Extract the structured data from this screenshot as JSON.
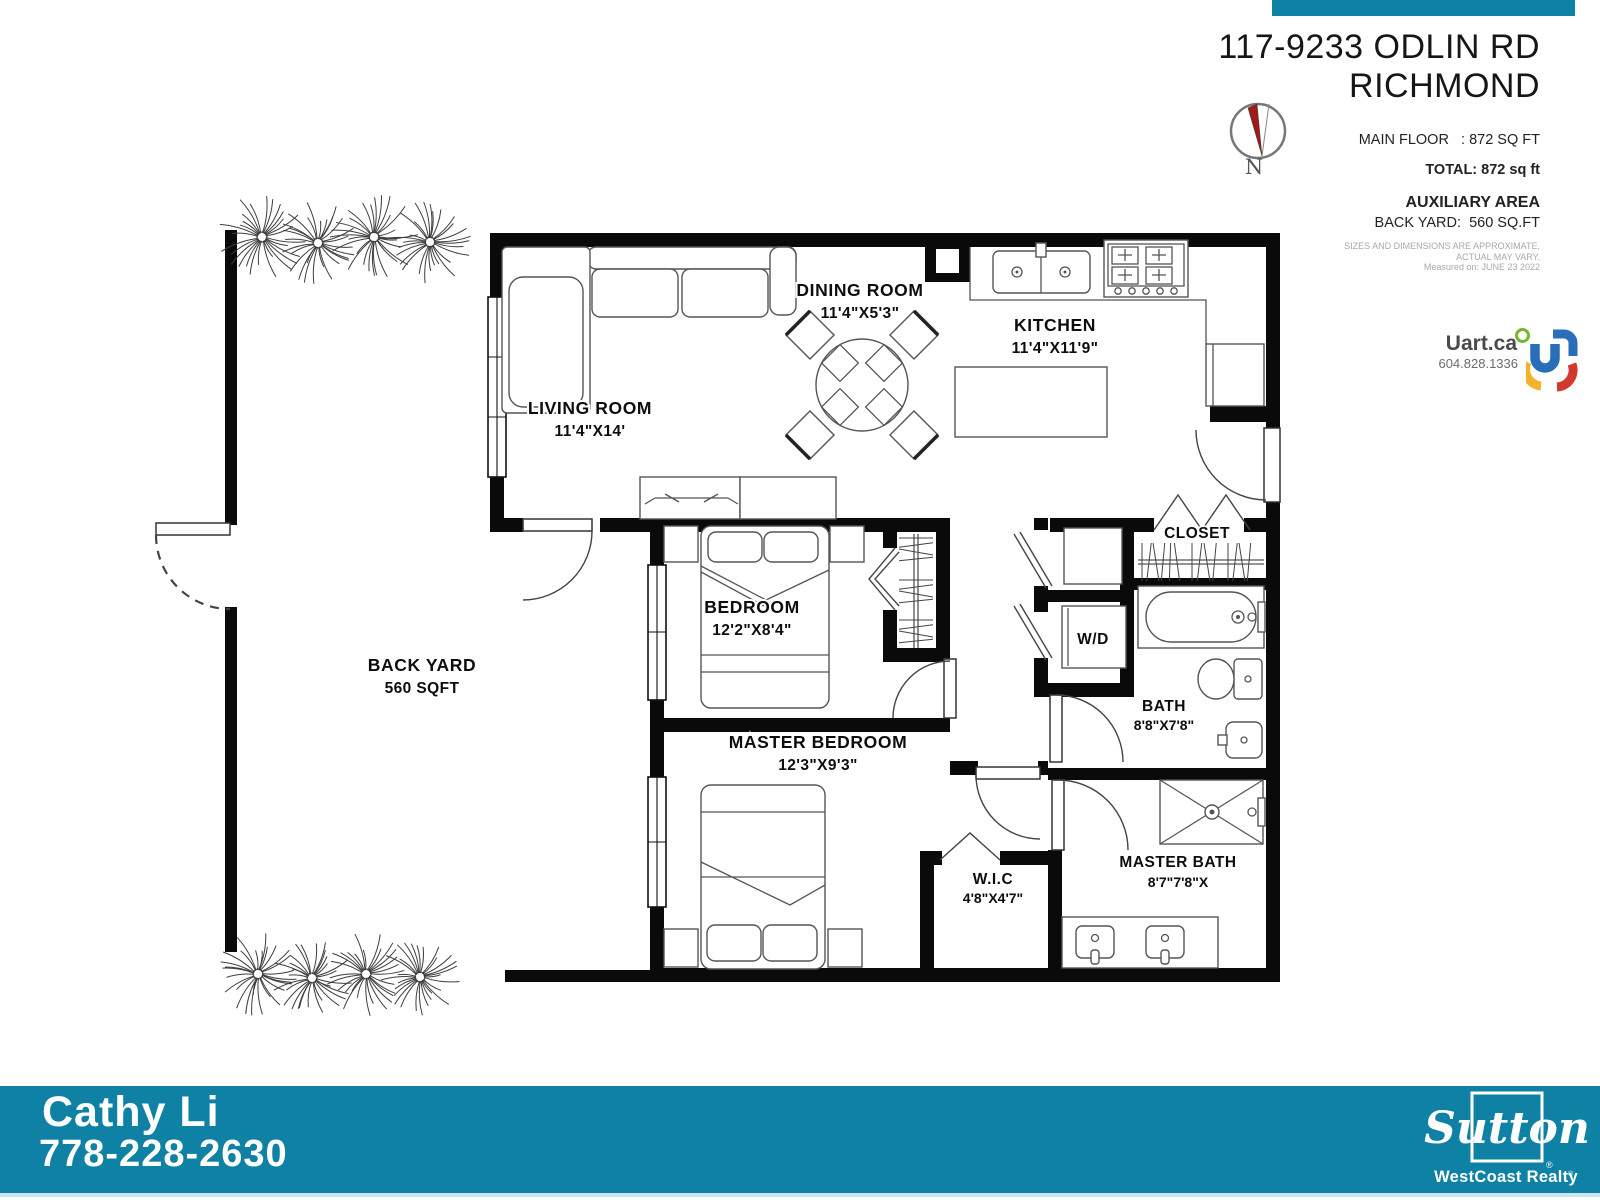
{
  "header": {
    "address_line1": "117-9233 ODLIN RD",
    "address_line2": "RICHMOND"
  },
  "compass": {
    "label": "N"
  },
  "summary": {
    "main_floor": "MAIN FLOOR   : 872 SQ FT",
    "total": "TOTAL: 872 sq ft",
    "aux_title": "AUXILIARY AREA",
    "aux_value": "BACK YARD:  560 SQ.FT",
    "disclaimer1": "SIZES AND DIMENSIONS ARE APPROXIMATE,",
    "disclaimer2": "ACTUAL MAY VARY.",
    "disclaimer3": "Measured on: JUNE 23 2022"
  },
  "branding": {
    "company": "Uart.ca",
    "phone": "604.828.1336"
  },
  "rooms": {
    "living": {
      "name": "LIVING ROOM",
      "dims": "11'4\"X14'"
    },
    "dining": {
      "name": "DINING ROOM",
      "dims": "11'4\"X5'3\""
    },
    "kitchen": {
      "name": "KITCHEN",
      "dims": "11'4\"X11'9\""
    },
    "bedroom": {
      "name": "BEDROOM",
      "dims": "12'2\"X8'4\""
    },
    "master_bedroom": {
      "name": "MASTER BEDROOM",
      "dims": "12'3\"X9'3\""
    },
    "closet": {
      "name": "CLOSET"
    },
    "wd": {
      "name": "W/D"
    },
    "bath": {
      "name": "BATH",
      "dims": "8'8\"X7'8\""
    },
    "wic": {
      "name": "W.I.C",
      "dims": "4'8\"X4'7\""
    },
    "master_bath": {
      "name": "MASTER BATH",
      "dims": "8'7\"7'8\"X"
    },
    "back_yard": {
      "name": "BACK YARD",
      "dims": "560 SQFT"
    }
  },
  "footer": {
    "agent_name": "Cathy Li",
    "agent_phone": "778-228-2630",
    "brokerage": "Sutton",
    "brokerage_sub": "WestCoast Realty",
    "reg_mark": "®"
  },
  "colors": {
    "bar_teal": "#0e81a4",
    "needle_red": "#9e1b1b",
    "uart_blue": "#2a6db8",
    "uart_yellow": "#f3b229",
    "uart_red": "#d2392e",
    "uart_green": "#76b82a"
  }
}
